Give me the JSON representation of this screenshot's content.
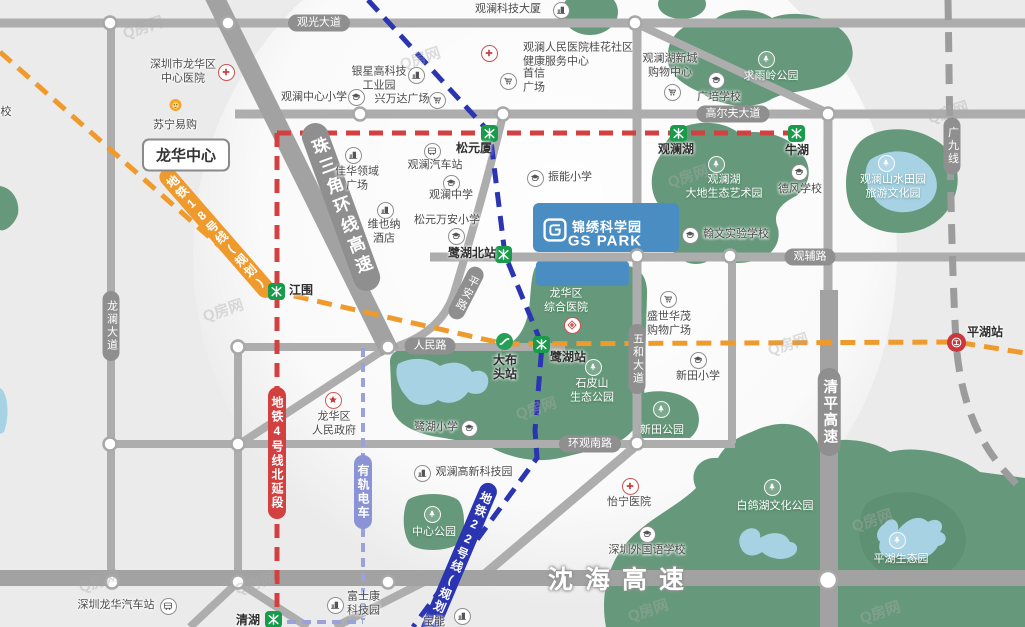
{
  "watermark": {
    "text": "Q房网",
    "positions": [
      [
        143,
        27
      ],
      [
        420,
        58
      ],
      [
        688,
        176
      ],
      [
        536,
        408
      ],
      [
        788,
        344
      ],
      [
        223,
        310
      ],
      [
        872,
        520
      ],
      [
        880,
        612
      ],
      [
        99,
        581
      ],
      [
        648,
        610
      ],
      [
        948,
        112
      ],
      [
        255,
        583
      ]
    ]
  },
  "area_labels": {
    "longhua_center": "龙华中心",
    "partial_school": "校"
  },
  "gs_park": {
    "name_cn": "锦绣科学园",
    "name_en": "GS PARK",
    "accent": "#4a8dc2"
  },
  "palette": {
    "road": "#adadad",
    "highway": "#a2a2a2",
    "pill": "#8f8f8f",
    "green": "#66997b",
    "water": "#a6d2e4",
    "metro_red": "#d24040",
    "metro_orange": "#ef9a2d",
    "metro_blue": "#2b35b2",
    "tram": "#8a93d6",
    "station_green": "#189b4b"
  },
  "road_labels": [
    {
      "text": "观光大道",
      "x": 319,
      "y": 23,
      "dir": "h"
    },
    {
      "text": "高尔夫大道",
      "x": 733,
      "y": 114,
      "dir": "h"
    },
    {
      "text": "观辅路",
      "x": 810,
      "y": 257,
      "dir": "h"
    },
    {
      "text": "人民路",
      "x": 430,
      "y": 346,
      "dir": "h"
    },
    {
      "text": "环观南路",
      "x": 590,
      "y": 444,
      "dir": "h"
    },
    {
      "text": "龙澜大道",
      "x": 111,
      "y": 326,
      "dir": "v"
    },
    {
      "text": "五和大道",
      "x": 637,
      "y": 359,
      "dir": "v"
    },
    {
      "text": "清平高速",
      "x": 829,
      "y": 412,
      "dir": "v",
      "kind": "big"
    },
    {
      "text": "广九线",
      "x": 952,
      "y": 146,
      "dir": "v"
    },
    {
      "text": "珠三角环线高速",
      "x": 341,
      "y": 207,
      "dir": "v",
      "rot": -20,
      "kind": "huge"
    },
    {
      "text": "平安路",
      "x": 466,
      "y": 293,
      "dir": "v",
      "rot": 27
    },
    {
      "text": "沈海高速",
      "x": 622,
      "y": 578,
      "dir": "h",
      "kind": "hwytext"
    }
  ],
  "transit_labels": [
    {
      "text": "地铁4号线北延段",
      "x": 277,
      "y": 453,
      "color": "red",
      "rot": 0
    },
    {
      "text": "有轨电车",
      "x": 363,
      "y": 492,
      "color": "tram",
      "rot": 0
    },
    {
      "text": "地铁18号线(规划)",
      "x": 217,
      "y": 233,
      "color": "orange",
      "rot": -41
    },
    {
      "text": "地铁22号线(规划)",
      "x": 459,
      "y": 560,
      "color": "blue",
      "rot": 23
    }
  ],
  "stations": [
    {
      "name": "松元厦",
      "type": "metro",
      "x": 490,
      "y": 134,
      "lx": 474,
      "ly": 149
    },
    {
      "name": "观澜湖",
      "type": "metro",
      "x": 679,
      "y": 134,
      "lx": 676,
      "ly": 150
    },
    {
      "name": "牛湖",
      "type": "metro",
      "x": 797,
      "y": 134,
      "lx": 797,
      "ly": 151
    },
    {
      "name": "江围",
      "type": "metro",
      "x": 277,
      "y": 292,
      "lx": 301,
      "ly": 291
    },
    {
      "name": "鹭湖北站",
      "type": "metro",
      "x": 504,
      "y": 255,
      "lx": 472,
      "ly": 254
    },
    {
      "name": "鹭湖站",
      "type": "metro",
      "x": 542,
      "y": 345,
      "lx": 568,
      "ly": 358
    },
    {
      "name": "清湖",
      "type": "metro",
      "x": 274,
      "y": 620,
      "lx": 248,
      "ly": 621
    },
    {
      "name": "大布\n头站",
      "type": "tram",
      "x": 505,
      "y": 342,
      "lx": 505,
      "ly": 368
    },
    {
      "name": "平湖站",
      "type": "rail",
      "x": 956,
      "y": 342,
      "lx": 985,
      "ly": 333
    }
  ],
  "pois": [
    {
      "lines": [
        "深圳市龙华区",
        "中心医院"
      ],
      "icon": "hospital",
      "ix": 226,
      "iy": 72,
      "x": 183,
      "y": 72
    },
    {
      "lines": [
        "苏宁易购"
      ],
      "icon": "lion",
      "ix": 175,
      "iy": 105,
      "x": 175,
      "y": 126
    },
    {
      "lines": [
        "观澜中心小学"
      ],
      "icon": "school",
      "ix": 356,
      "iy": 97,
      "x": 314,
      "y": 98
    },
    {
      "lines": [
        "银星高科技",
        "工业园"
      ],
      "icon": "building",
      "ix": 416,
      "iy": 75,
      "x": 379,
      "y": 79
    },
    {
      "lines": [
        "兴万达广场"
      ],
      "icon": "cart",
      "ix": 437,
      "iy": 100,
      "x": 402,
      "y": 100
    },
    {
      "lines": [
        "观澜科技大厦"
      ],
      "icon": "building",
      "ix": 561,
      "iy": 10,
      "x": 508,
      "y": 10
    },
    {
      "lines": [
        "观澜人民医院桂花社区",
        "健康服务中心"
      ],
      "icon": "hospital",
      "ix": 489,
      "iy": 53,
      "x": 523,
      "y": 55,
      "align": "left"
    },
    {
      "lines": [
        "首信",
        "广场"
      ],
      "icon": "cart",
      "ix": 508,
      "iy": 81,
      "x": 523,
      "y": 81,
      "align": "left"
    },
    {
      "lines": [
        "观澜湖新城",
        "购物中心"
      ],
      "icon": "cart",
      "ix": 672,
      "iy": 92,
      "x": 670,
      "y": 66
    },
    {
      "lines": [
        "广培学校"
      ],
      "icon": "school",
      "ix": 716,
      "iy": 80,
      "x": 719,
      "y": 98
    },
    {
      "lines": [
        "求雨岭公园"
      ],
      "icon": "tree",
      "ix": 766,
      "iy": 59,
      "x": 771,
      "y": 77,
      "theme": "white"
    },
    {
      "lines": [
        "观澜湖",
        "大地生态艺术园"
      ],
      "icon": "tree",
      "ix": 716,
      "iy": 164,
      "x": 724,
      "y": 187,
      "theme": "white"
    },
    {
      "lines": [
        "德风学校"
      ],
      "icon": "school",
      "ix": 799,
      "iy": 172,
      "x": 800,
      "y": 190
    },
    {
      "lines": [
        "观澜山水田园",
        "旅游文化园"
      ],
      "icon": "tree",
      "ix": 886,
      "iy": 163,
      "x": 893,
      "y": 187,
      "theme": "white"
    },
    {
      "lines": [
        "佳华领域",
        "广场"
      ],
      "icon": "building",
      "ix": 353,
      "iy": 155,
      "x": 357,
      "y": 179
    },
    {
      "lines": [
        "观澜汽车站"
      ],
      "icon": "bus",
      "ix": 432,
      "iy": 151,
      "x": 435,
      "y": 166
    },
    {
      "lines": [
        "观澜中学"
      ],
      "icon": "school",
      "ix": 451,
      "iy": 183,
      "x": 451,
      "y": 196
    },
    {
      "lines": [
        "维也纳",
        "酒店"
      ],
      "icon": "building",
      "ix": 385,
      "iy": 210,
      "x": 384,
      "y": 232
    },
    {
      "lines": [
        "松元万安小学"
      ],
      "icon": "school",
      "ix": 456,
      "iy": 236,
      "x": 447,
      "y": 221
    },
    {
      "lines": [
        "振能小学"
      ],
      "icon": "school",
      "ix": 535,
      "iy": 178,
      "x": 570,
      "y": 178
    },
    {
      "lines": [
        "翰文实验学校"
      ],
      "icon": "school",
      "ix": 690,
      "iy": 235,
      "x": 736,
      "y": 235
    },
    {
      "lines": [
        "龙华区",
        "综合医院"
      ],
      "icon": "diamond",
      "ix": 572,
      "iy": 325,
      "x": 566,
      "y": 301,
      "theme": "white"
    },
    {
      "lines": [
        "盛世华茂",
        "购物广场"
      ],
      "icon": "cart",
      "ix": 668,
      "iy": 299,
      "x": 669,
      "y": 324
    },
    {
      "lines": [
        "石皮山",
        "生态公园"
      ],
      "icon": "tree",
      "ix": 593,
      "iy": 367,
      "x": 592,
      "y": 391,
      "theme": "white"
    },
    {
      "lines": [
        "新田小学"
      ],
      "icon": "school",
      "ix": 698,
      "iy": 360,
      "x": 698,
      "y": 377
    },
    {
      "lines": [
        "鹭湖小学"
      ],
      "icon": "school",
      "ix": 469,
      "iy": 428,
      "x": 436,
      "y": 428
    },
    {
      "lines": [
        "龙华区",
        "人民政府"
      ],
      "icon": "star",
      "ix": 333,
      "iy": 400,
      "x": 334,
      "y": 424
    },
    {
      "lines": [
        "观澜高新科技园"
      ],
      "icon": "building",
      "ix": 422,
      "iy": 473,
      "x": 474,
      "y": 473
    },
    {
      "lines": [
        "新田公园"
      ],
      "icon": "tree",
      "ix": 661,
      "iy": 409,
      "x": 662,
      "y": 431,
      "theme": "white"
    },
    {
      "lines": [
        "中心公园"
      ],
      "icon": "tree",
      "ix": 432,
      "iy": 514,
      "x": 434,
      "y": 533,
      "theme": "white"
    },
    {
      "lines": [
        "怡宁医院"
      ],
      "icon": "hospital",
      "ix": 630,
      "iy": 486,
      "x": 629,
      "y": 503
    },
    {
      "lines": [
        "深圳外国语学校"
      ],
      "icon": "school",
      "ix": 647,
      "iy": 534,
      "x": 647,
      "y": 551
    },
    {
      "lines": [
        "白鸽湖文化公园"
      ],
      "icon": "tree",
      "ix": 772,
      "iy": 487,
      "x": 775,
      "y": 507,
      "theme": "white"
    },
    {
      "lines": [
        "平湖生态园"
      ],
      "icon": "tree",
      "ix": 897,
      "iy": 540,
      "x": 901,
      "y": 560,
      "theme": "white"
    },
    {
      "lines": [
        "富士康",
        "科技园"
      ],
      "icon": "building",
      "ix": 335,
      "iy": 605,
      "x": 347,
      "y": 604,
      "align": "left"
    },
    {
      "lines": [
        "深圳龙华汽车站"
      ],
      "icon": "bus",
      "ix": 168,
      "iy": 606,
      "x": 116,
      "y": 606
    },
    {
      "lines": [
        "宝能"
      ],
      "icon": "building",
      "ix": 462,
      "iy": 616,
      "x": 434,
      "y": 623
    }
  ]
}
